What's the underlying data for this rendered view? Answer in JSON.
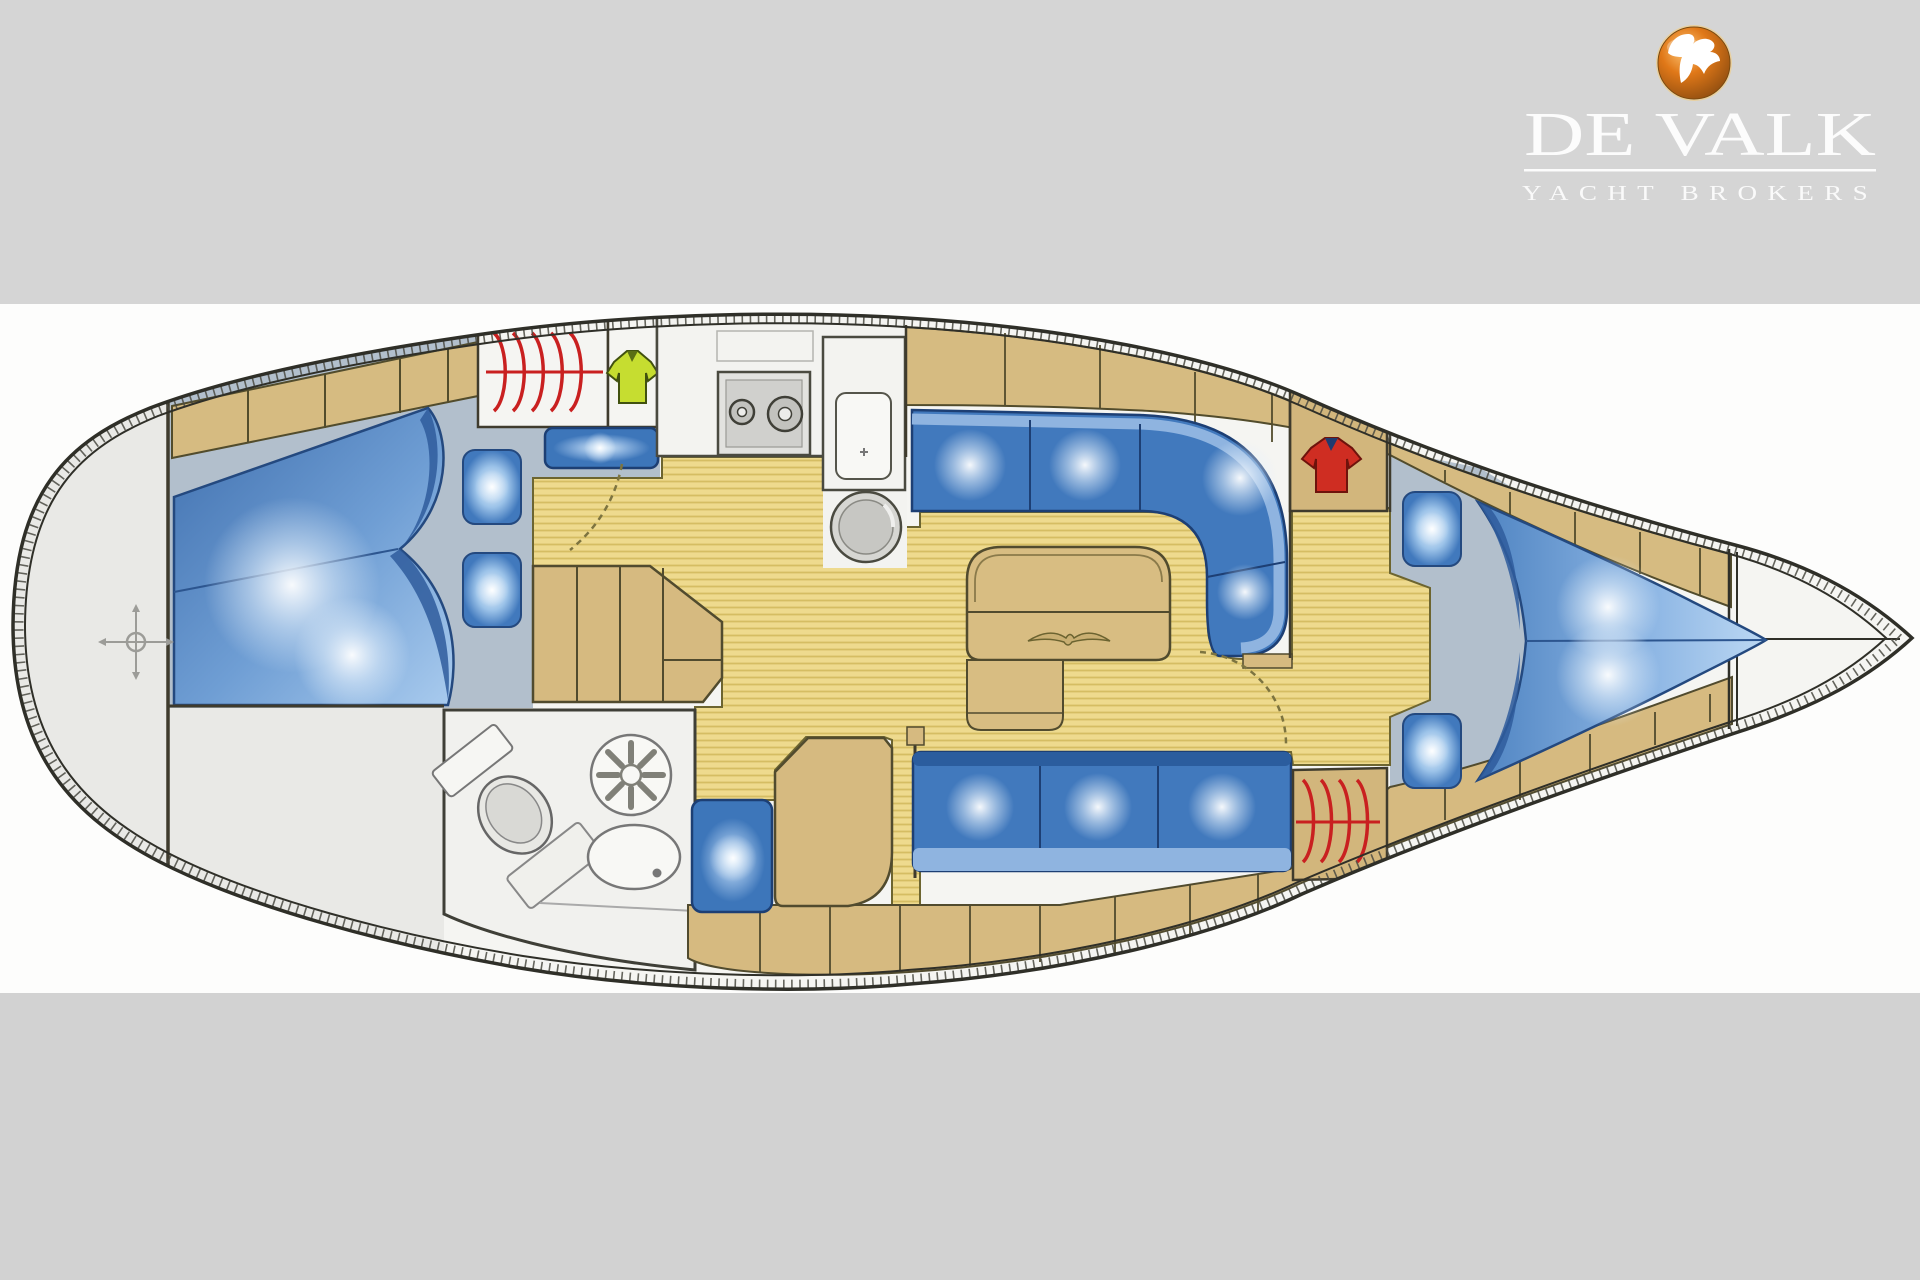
{
  "logo": {
    "brand": "DE VALK",
    "tagline": "YACHT BROKERS",
    "emblem": "falcon-sphere-icon",
    "emblem_color": "#dd7a18",
    "text_color": "#fcfcfc"
  },
  "page": {
    "band_top_color": "#d5d5d5",
    "band_middle_color": "#fdfdfc",
    "band_bottom_color": "#d2d2d2"
  },
  "plan": {
    "type": "sailing-yacht-interior-floorplan",
    "orientation": "bow-to-the-right",
    "colors": {
      "hull_outline": "#2f2f28",
      "deck_white": "#f5f5f2",
      "transom_grey": "#e9e9e6",
      "cabin_sole_grey": "#b2bfcc",
      "teak_floor": "#eeda8e",
      "teak_stripe": "#d5bd63",
      "wood": "#d6bb81",
      "wood_outline": "#524c2c",
      "upholstery_blue": "#4179bd",
      "upholstery_dark": "#2b5d9e",
      "upholstery_light": "#8fb4e0",
      "accent_red": "#c92020",
      "shirt_yellow": "#c6dd30",
      "shirt_red": "#cf2d22"
    },
    "icons": [
      "compass-crosshair-icon",
      "clothes-rail-icon",
      "yellow-shirt-icon",
      "red-shirt-icon",
      "stove-icon",
      "galley-sink-icon",
      "round-basin-icon",
      "shower-icon",
      "toilet-icon",
      "washbasin-icon",
      "double-berth-icon",
      "v-berth-icon",
      "pillow-icon",
      "settee-icon",
      "saloon-table-icon",
      "companionway-steps-icon",
      "chart-table-icon",
      "door-swing-icon"
    ]
  }
}
